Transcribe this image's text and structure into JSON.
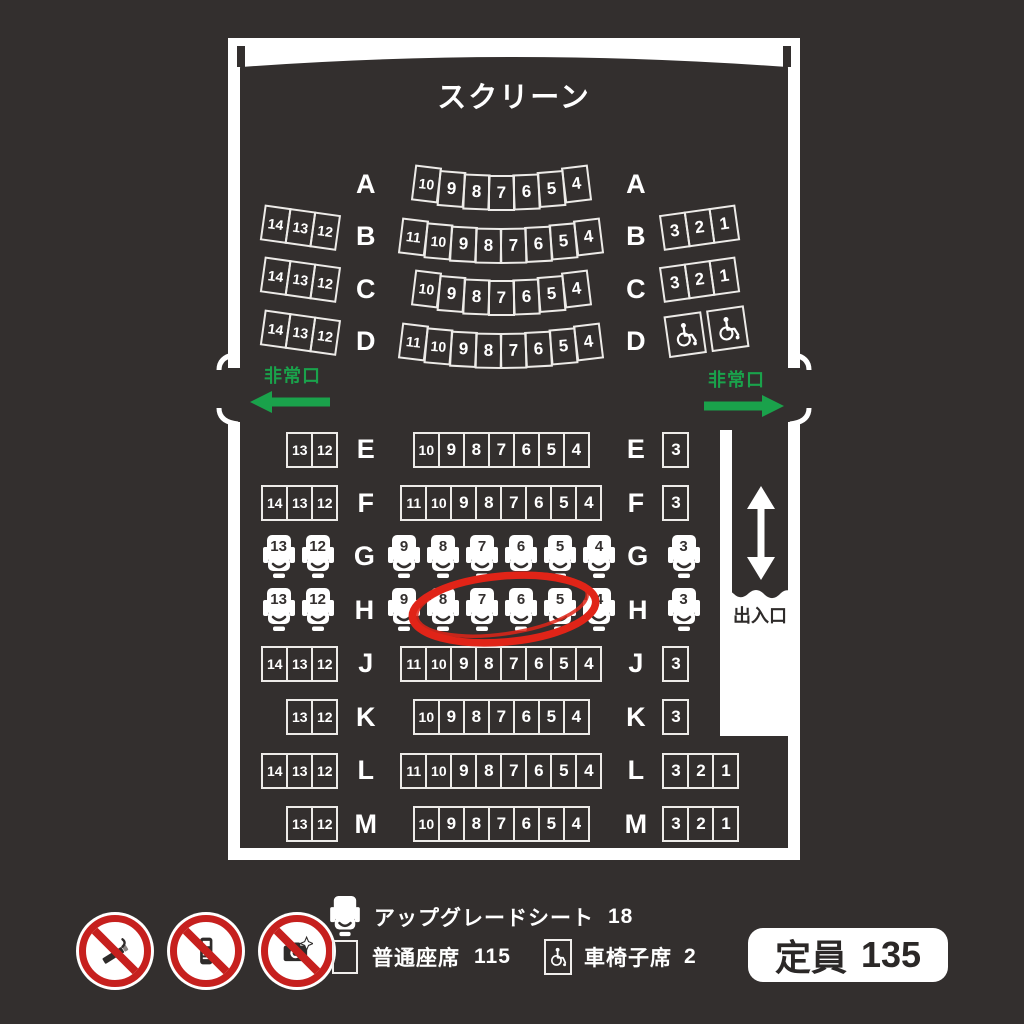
{
  "colors": {
    "background": "#332f2e",
    "wall_white": "#ffffff",
    "seat_border": "#edebe8",
    "exit_green": "#1aa24b",
    "annotation_red": "#e02418",
    "prohibition_red": "#c6201e",
    "badge_text": "#2b2827"
  },
  "screen_label": "スクリーン",
  "exit_label_left": "非常口",
  "exit_label_right": "非常口",
  "entrance_label": "出入口",
  "rows": [
    {
      "label": "A",
      "block": "upper",
      "curved": true,
      "seat_type": "normal",
      "left": [],
      "center": [
        "10",
        "9",
        "8",
        "7",
        "6",
        "5",
        "4"
      ],
      "right": []
    },
    {
      "label": "B",
      "block": "upper",
      "curved": true,
      "seat_type": "normal",
      "left": [
        "14",
        "13",
        "12"
      ],
      "center": [
        "11",
        "10",
        "9",
        "8",
        "7",
        "6",
        "5",
        "4"
      ],
      "right": [
        "3",
        "2",
        "1"
      ]
    },
    {
      "label": "C",
      "block": "upper",
      "curved": true,
      "seat_type": "normal",
      "left": [
        "14",
        "13",
        "12"
      ],
      "center": [
        "10",
        "9",
        "8",
        "7",
        "6",
        "5",
        "4"
      ],
      "right": [
        "3",
        "2",
        "1"
      ]
    },
    {
      "label": "D",
      "block": "upper",
      "curved": true,
      "seat_type": "normal",
      "left": [
        "14",
        "13",
        "12"
      ],
      "center": [
        "11",
        "10",
        "9",
        "8",
        "7",
        "6",
        "5",
        "4"
      ],
      "right": [],
      "wheelchair_right": 2
    },
    {
      "label": "E",
      "block": "lower",
      "curved": false,
      "seat_type": "normal",
      "left": [
        "13",
        "12"
      ],
      "center": [
        "10",
        "9",
        "8",
        "7",
        "6",
        "5",
        "4"
      ],
      "right": [
        "3"
      ]
    },
    {
      "label": "F",
      "block": "lower",
      "curved": false,
      "seat_type": "normal",
      "left": [
        "14",
        "13",
        "12"
      ],
      "center": [
        "11",
        "10",
        "9",
        "8",
        "7",
        "6",
        "5",
        "4"
      ],
      "right": [
        "3"
      ]
    },
    {
      "label": "G",
      "block": "lower",
      "curved": false,
      "seat_type": "upgrade",
      "left": [
        "13",
        "12"
      ],
      "center": [
        "9",
        "8",
        "7",
        "6",
        "5",
        "4"
      ],
      "right": [
        "3"
      ]
    },
    {
      "label": "H",
      "block": "lower",
      "curved": false,
      "seat_type": "upgrade",
      "left": [
        "13",
        "12"
      ],
      "center": [
        "9",
        "8",
        "7",
        "6",
        "5",
        "4"
      ],
      "right": [
        "3"
      ]
    },
    {
      "label": "J",
      "block": "lower",
      "curved": false,
      "seat_type": "normal",
      "left": [
        "14",
        "13",
        "12"
      ],
      "center": [
        "11",
        "10",
        "9",
        "8",
        "7",
        "6",
        "5",
        "4"
      ],
      "right": [
        "3"
      ]
    },
    {
      "label": "K",
      "block": "lower",
      "curved": false,
      "seat_type": "normal",
      "left": [
        "13",
        "12"
      ],
      "center": [
        "10",
        "9",
        "8",
        "7",
        "6",
        "5",
        "4"
      ],
      "right": [
        "3"
      ]
    },
    {
      "label": "L",
      "block": "lower",
      "curved": false,
      "seat_type": "normal",
      "left": [
        "14",
        "13",
        "12"
      ],
      "center": [
        "11",
        "10",
        "9",
        "8",
        "7",
        "6",
        "5",
        "4"
      ],
      "right": [
        "3",
        "2",
        "1"
      ]
    },
    {
      "label": "M",
      "block": "lower",
      "curved": false,
      "seat_type": "normal",
      "left": [
        "13",
        "12"
      ],
      "center": [
        "10",
        "9",
        "8",
        "7",
        "6",
        "5",
        "4"
      ],
      "right": [
        "3",
        "2",
        "1"
      ]
    }
  ],
  "annotation": {
    "shape": "hand-drawn-ellipse",
    "color": "#e02418",
    "row": "H",
    "seats": [
      "8",
      "7",
      "6",
      "5"
    ]
  },
  "prohibition_icons": [
    "no-smoking-icon",
    "no-mobile-phone-icon",
    "no-camera-icon"
  ],
  "legend": {
    "upgrade": {
      "label": "アップグレードシート",
      "count": "18"
    },
    "normal": {
      "label": "普通座席",
      "count": "115"
    },
    "wheelchair": {
      "label": "車椅子席",
      "count": "2"
    }
  },
  "capacity": {
    "label": "定員",
    "value": "135"
  }
}
